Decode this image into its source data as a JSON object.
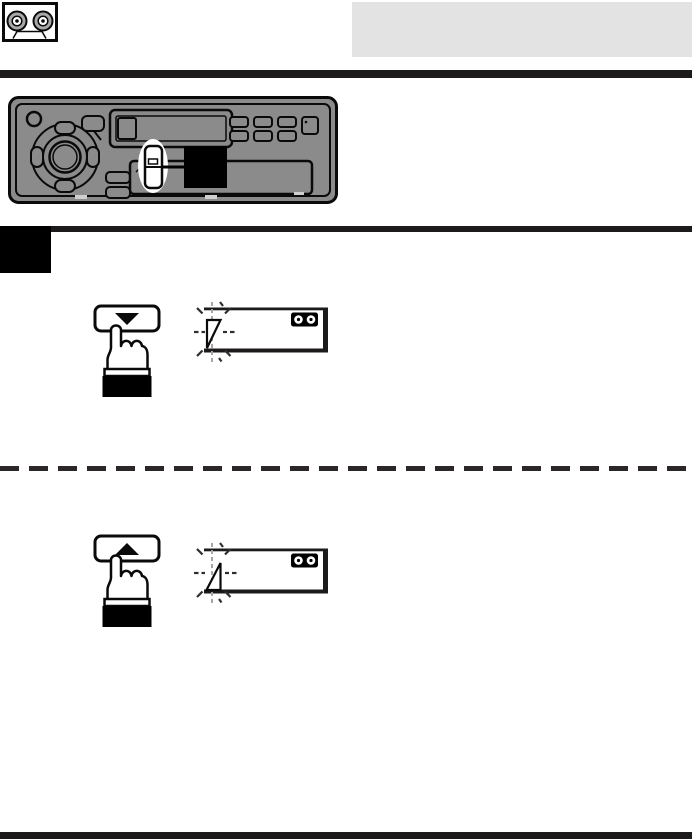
{
  "page": {
    "background": "#ffffff"
  },
  "header": {
    "section_icon": "cassette-tape-icon",
    "title_box": {
      "color": "#e4e3e3",
      "text": ""
    },
    "top_rule_color": "#1d1a1b"
  },
  "device_illustration": {
    "name": "car-stereo-front-panel",
    "body_color": "#8b8b8b",
    "outline_color": "#0a0a0a",
    "highlight_ellipse_color": "#ffffff",
    "callout_square_color": "#000000",
    "highlighted_control": "tape-program-rocker-button"
  },
  "step": {
    "marker_color": "#000000",
    "rule_color": "#1d1a1b"
  },
  "instructions": [
    {
      "button_icon": "triangle-down-icon",
      "button_symbol": "▼",
      "hand_icon": "finger-press-icon",
      "display": {
        "blinking_indicator_icon": "tape-direction-triangle-icon",
        "indicator_shape": "right-triangle-vertical-left-edge",
        "cassette_icon": "cassette-indicator-icon"
      }
    },
    {
      "button_icon": "triangle-up-icon",
      "button_symbol": "▲",
      "hand_icon": "finger-press-icon",
      "display": {
        "blinking_indicator_icon": "tape-direction-triangle-icon",
        "indicator_shape": "right-triangle-vertical-right-edge",
        "cassette_icon": "cassette-indicator-icon"
      }
    }
  ],
  "separators": {
    "dashed_rule_color": "#2b2728",
    "bottom_rule_color": "#1d1a1b"
  }
}
